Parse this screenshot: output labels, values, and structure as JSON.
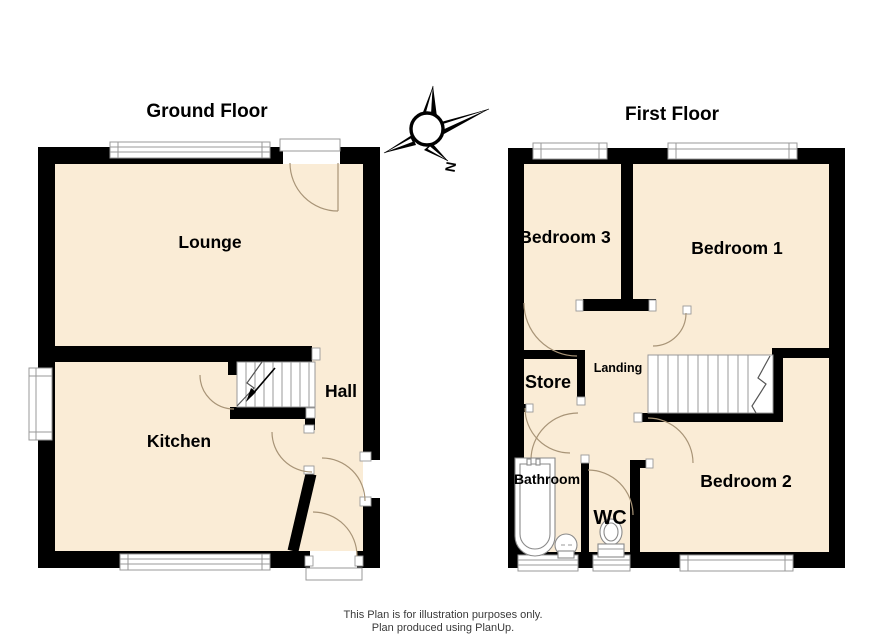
{
  "page": {
    "background": "#FFFFFF"
  },
  "ground_floor": {
    "title": "Ground Floor",
    "rooms": [
      {
        "name": "Lounge"
      },
      {
        "name": "Kitchen"
      },
      {
        "name": "Hall"
      }
    ]
  },
  "first_floor": {
    "title": "First Floor",
    "rooms": [
      {
        "name": "Bedroom 3"
      },
      {
        "name": "Bedroom 1"
      },
      {
        "name": "Bedroom 2"
      },
      {
        "name": "Store"
      },
      {
        "name": "Landing"
      },
      {
        "name": "Bathroom"
      },
      {
        "name": "WC"
      }
    ]
  },
  "compass": {
    "north_label": "N"
  },
  "footer": {
    "line1": "This Plan is for illustration purposes only.",
    "line2": "Plan produced using PlanUp."
  },
  "colors": {
    "floor_fill": "#FAECD6",
    "wall": "#000000",
    "door_arc": "#A89477",
    "window_frame": "#999999",
    "stair_line": "#999999",
    "text": "#000000"
  }
}
